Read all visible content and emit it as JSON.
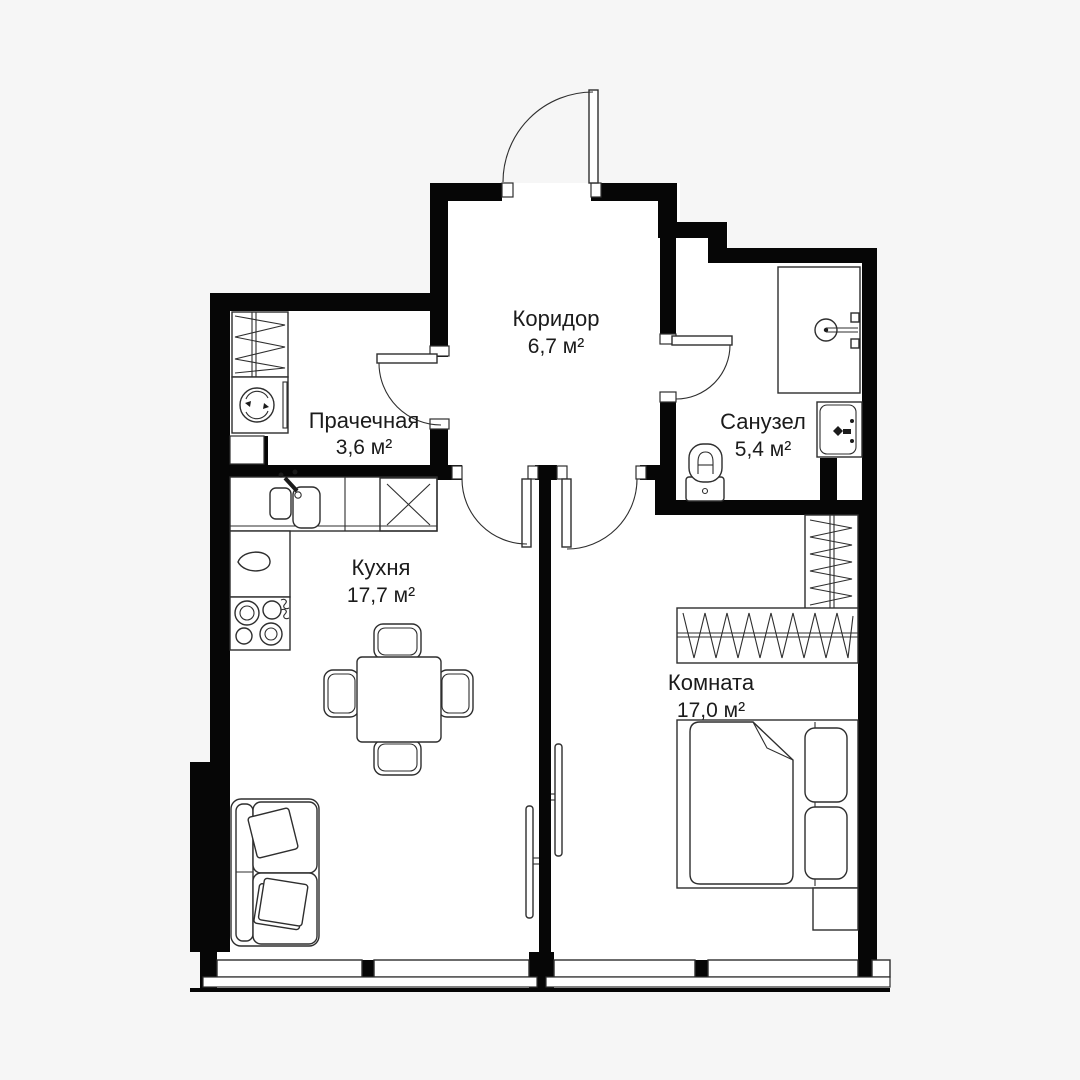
{
  "title": "Apartment floor plan",
  "rooms": [
    {
      "id": "corridor",
      "name": "Коридор",
      "area": "6,7 м²"
    },
    {
      "id": "laundry",
      "name": "Прачечная",
      "area": "3,6 м²"
    },
    {
      "id": "bathroom",
      "name": "Санузел",
      "area": "5,4 м²"
    },
    {
      "id": "kitchen",
      "name": "Кухня",
      "area": "17,7 м²"
    },
    {
      "id": "room",
      "name": "Комната",
      "area": "17,0 м²"
    }
  ],
  "colors": {
    "background": "#f6f6f6",
    "room_fill": "#ffffff",
    "wall": "#060606",
    "line": "#2e2e2e",
    "text": "#1b1b1b"
  }
}
